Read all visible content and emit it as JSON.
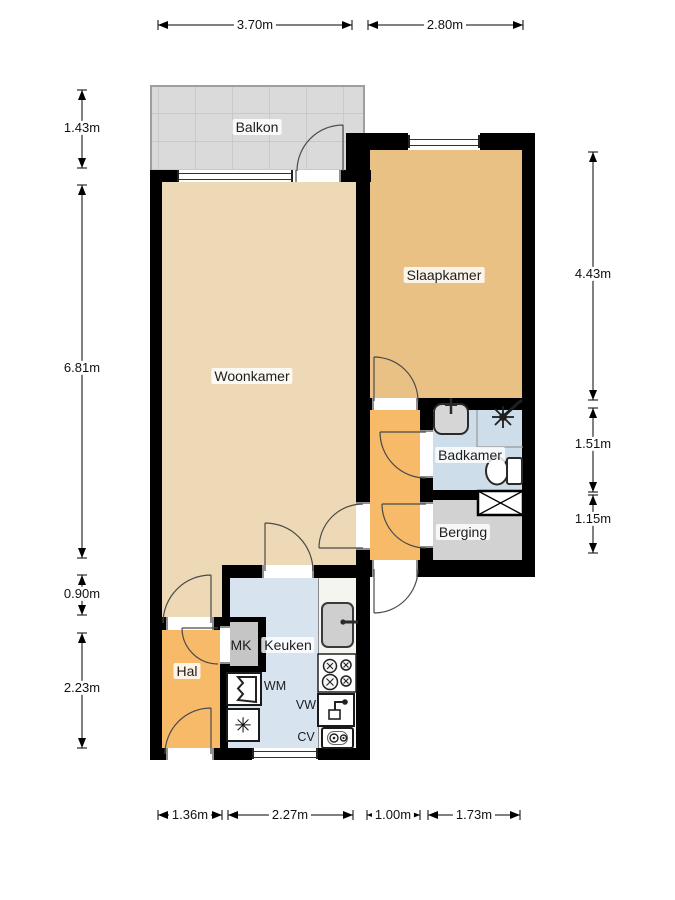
{
  "labels": {
    "balkon": "Balkon",
    "woonkamer": "Woonkamer",
    "slaapkamer": "Slaapkamer",
    "badkamer": "Badkamer",
    "berging": "Berging",
    "keuken": "Keuken",
    "hal": "Hal",
    "mk": "MK",
    "wm": "WM",
    "vw": "VW",
    "cv": "CV"
  },
  "dims": {
    "top1": "3.70m",
    "top2": "2.80m",
    "left1": "1.43m",
    "left2": "6.81m",
    "left3": "0.90m",
    "left4": "2.23m",
    "right1": "4.43m",
    "right2": "1.51m",
    "right3": "1.15m",
    "bottom1": "1.36m",
    "bottom2": "2.27m",
    "bottom3": "1.00m",
    "bottom4": "1.73m"
  },
  "glyphs": {
    "freezer": "✳"
  },
  "icons": {
    "shower": "shower-head-icon",
    "toilet": "toilet-icon",
    "washbasin": "washbasin-icon",
    "kitchen_sink": "kitchen-sink-icon",
    "stove": "stove-four-burner-icon",
    "washing_machine": "washing-machine-icon",
    "freezer": "freezer-icon",
    "dishwasher": "dishwasher-icon",
    "boiler": "cv-boiler-icon",
    "closet": "fixed-closet-cross-icon"
  },
  "colors": {
    "wall": "#000000",
    "woonkamer": "#eed9b7",
    "slaapkamer": "#eac184",
    "hal": "#f6ba68",
    "corridor": "#f6ba68",
    "keuken": "#d8e3f0",
    "badkamer": "#cddde9",
    "berging": "#d2d2d2",
    "balkon": "#dadada",
    "mk": "#c5c5c5",
    "counter": "#f5f5ef"
  }
}
